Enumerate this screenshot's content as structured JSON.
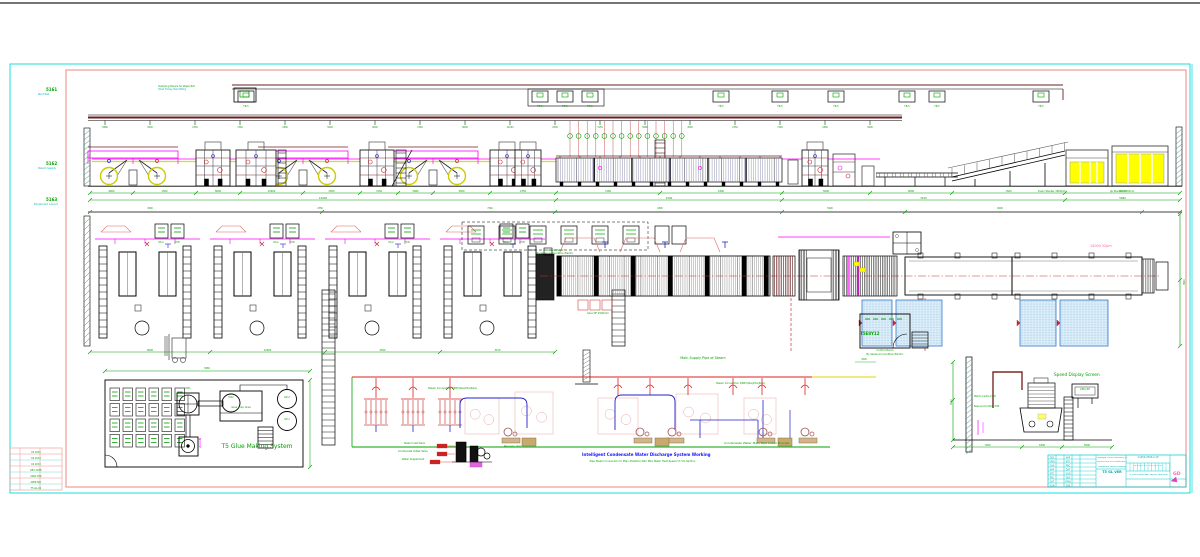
{
  "page": {
    "bg": "#ffffff",
    "border_cyan": "#00dcdc",
    "border_pink": "#f09090"
  },
  "margin": {
    "sections": [
      {
        "code": "5161",
        "label": "Roof Rail"
      },
      {
        "code": "5162",
        "label": "Steam Supply"
      },
      {
        "code": "5163",
        "label": "Equipment Layout"
      }
    ]
  },
  "elevation": {
    "hanger_note1": "Clamping Device for Paper Roll",
    "hanger_note2": "Hoist Trolley Rail 500kg",
    "stacker_note1": "Down Stacker 1800mm",
    "stacker_note2": "Up Stacker 1800mm"
  },
  "plan": {
    "panel_note1": "Control Panel",
    "panel_note2": "By Series Air Condition Electric",
    "df_note": "Glue DF 2500mm",
    "conveyor_note": "14000 52pm",
    "control_room": {
      "code": "T5E8Y12",
      "line1": "Control Room",
      "line2": "By Series Air Condition Electric"
    }
  },
  "glue": {
    "title": "T5 Glue Making System",
    "mixer_label": "MX1",
    "wheel_label": "MX2",
    "platform": "Glue Prep Area",
    "tank1": "GP-2",
    "tank2": "GP-1",
    "pump_code": "N555P"
  },
  "piping": {
    "main_label": "Main Supply Pipe of Steam",
    "conn_label1": "Steam Connection DN25(Dia)25A(Size)",
    "conn_label2": "Steam Connection DN25(Dia)25A(Size)",
    "condensate_label": "Condensate Water Main Pipe Lower Bracket",
    "intelligent_title": "Intelligent Condensate Water Discharge System Working",
    "intelligent_sub": "Pipe Steam Connection to Main 25A(Dia) 30m Max Water Heat Speed 17.5m Section",
    "callout1": "Steam Inlet Valve",
    "callout2": "Condensate Outlet Valve",
    "callout3": "Water Supplement",
    "device_label": "Recovery Unit"
  },
  "speed": {
    "title": "Speed Display Screen",
    "screen_label": "LED-5P",
    "note1": "Wall to Centre 1500",
    "note2": "Base Anchor Bolts M16"
  },
  "title_block": {
    "company": "Guangda Carton Machinery Mfg. Co., Ltd.",
    "project": "WJ250-2500-5LR Production Line",
    "drawing": "Equipment Layout Drawing",
    "code": "T5 GL VER",
    "no": "A1250-2500-2-1P",
    "boxes": "A B C D E F G H J K L M",
    "note": "T5 Line Equipment Layout Approval",
    "logo": "GD"
  },
  "micro": {
    "dims": [
      "5680",
      "4500",
      "2350",
      "7260",
      "1800",
      "5600",
      "9000",
      "1560",
      "8000",
      "12000",
      "2500",
      "3150"
    ],
    "hanger": "TR-5",
    "unit_labels": [
      "RS-A",
      "PH-B"
    ],
    "grid_cells": [
      "DES",
      "DRW",
      "CHK",
      "APP",
      "STD",
      "PRC",
      "DAT",
      "SGN"
    ],
    "rev_rows": [
      "03  2015",
      "02  2014",
      "01  2013",
      "REV DATE",
      "SIGN  CHK",
      "APPR  NO.",
      "T5-GL-01"
    ]
  }
}
